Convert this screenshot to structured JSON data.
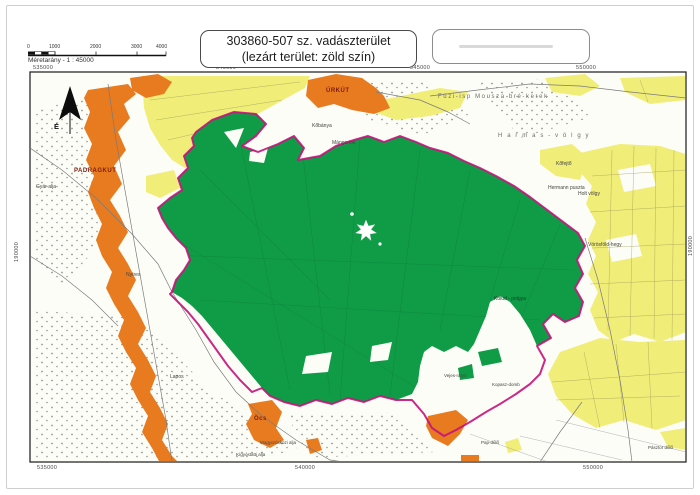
{
  "header": {
    "title_line1": "303860-507 sz. vadászterület",
    "title_line2": "(lezárt terület: zöld szín)",
    "scale_caption": "Méretarány - 1 : 45000",
    "scale_ticks": [
      {
        "label": "0",
        "x": 27
      },
      {
        "label": "1000",
        "x": 49
      },
      {
        "label": "2000",
        "x": 90
      },
      {
        "label": "3000",
        "x": 131
      },
      {
        "label": "4000",
        "x": 156
      }
    ]
  },
  "map": {
    "north_label": "É",
    "colors": {
      "closed_area": "#109c47",
      "farmland": "#f1ed79",
      "settlement": "#e87a20",
      "boundary": "#c4137a"
    },
    "coordinates": {
      "top": [
        {
          "label": "535000",
          "x": 33,
          "y": 65
        },
        {
          "label": "540000",
          "x": 216,
          "y": 65
        },
        {
          "label": "545000",
          "x": 410,
          "y": 65
        },
        {
          "label": "550000",
          "x": 576,
          "y": 65
        }
      ],
      "bottom": [
        {
          "label": "535000",
          "x": 37,
          "y": 465
        },
        {
          "label": "540000",
          "x": 295,
          "y": 465
        },
        {
          "label": "550000",
          "x": 583,
          "y": 465
        }
      ],
      "left": [
        {
          "label": "190000",
          "x": 14,
          "y": 262,
          "v": true
        }
      ],
      "right": [
        {
          "label": "190000",
          "x": 688,
          "y": 256,
          "v": true
        }
      ]
    },
    "labels": [
      {
        "text": "É",
        "x": 54,
        "y": 122,
        "cls": "north"
      },
      {
        "text": "PADRAGKUT",
        "x": 74,
        "y": 168,
        "cls": "settlement"
      },
      {
        "text": "ÚRKÚT",
        "x": 326,
        "y": 88,
        "cls": "settlement"
      },
      {
        "text": "Öcs",
        "x": 254,
        "y": 416,
        "cls": "settlement"
      },
      {
        "text": "H a r m a s - v ö l g y",
        "x": 498,
        "y": 133,
        "cls": "terrain-big"
      },
      {
        "text": "Füzi-isp  Mousza  bré-kerek",
        "x": 438,
        "y": 94,
        "cls": "terrain-big"
      },
      {
        "text": "Hermann puszta",
        "x": 548,
        "y": 185,
        "cls": "terrain"
      },
      {
        "text": "Kőfejtő",
        "x": 556,
        "y": 161,
        "cls": "terrain"
      },
      {
        "text": "Holt völgy",
        "x": 578,
        "y": 191,
        "cls": "terrain"
      },
      {
        "text": "Nyíres",
        "x": 126,
        "y": 272,
        "cls": "terrain"
      },
      {
        "text": "Lapos",
        "x": 170,
        "y": 374,
        "cls": "terrain"
      },
      {
        "text": "Kőbánya",
        "x": 312,
        "y": 123,
        "cls": "terrain"
      },
      {
        "text": "Mángorlós",
        "x": 332,
        "y": 140,
        "cls": "terrain"
      },
      {
        "text": "Gyár alja",
        "x": 36,
        "y": 184,
        "cls": "terrain"
      },
      {
        "text": "Vörösföld-hegy",
        "x": 588,
        "y": 242,
        "cls": "terrain"
      },
      {
        "text": "Kopasz-domb",
        "x": 492,
        "y": 382,
        "cls": "terrain-s"
      },
      {
        "text": "Vejes-ratyó",
        "x": 444,
        "y": 373,
        "cls": "terrain-s"
      },
      {
        "text": "Kőlud - polgya",
        "x": 494,
        "y": 296,
        "cls": "on-green"
      },
      {
        "text": "Mogyorósközi alja",
        "x": 260,
        "y": 440,
        "cls": "terrain-s"
      },
      {
        "text": "Kígyóstatti alja",
        "x": 236,
        "y": 452,
        "cls": "terrain-s"
      },
      {
        "text": "Pap-dűlő",
        "x": 481,
        "y": 440,
        "cls": "terrain-s"
      },
      {
        "text": "Pásztor dűlő",
        "x": 648,
        "y": 445,
        "cls": "terrain-s"
      }
    ]
  }
}
